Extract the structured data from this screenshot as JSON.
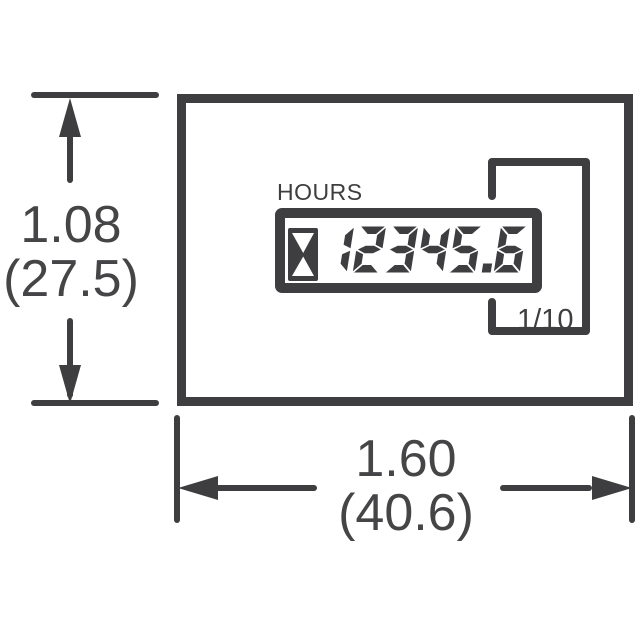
{
  "drawing": {
    "device": {
      "unit_label": "HOURS",
      "display_value": "12345.6",
      "fraction_label": "1/10",
      "icons": {
        "hourglass": "hourglass-icon"
      }
    },
    "dimensions": {
      "height": {
        "inches": "1.08",
        "millimeters": "(27.5)"
      },
      "width": {
        "inches": "1.60",
        "millimeters": "(40.6)"
      }
    },
    "colors": {
      "line": "#3e3e40",
      "text": "#454547",
      "background": "#ffffff"
    }
  }
}
